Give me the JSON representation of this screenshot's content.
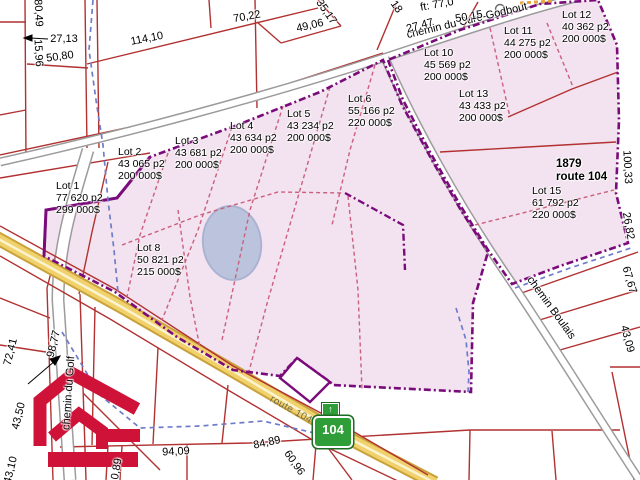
{
  "map": {
    "type": "cadastral-lots-for-sale"
  },
  "colors": {
    "parcel_line_red": "#b23131",
    "highlight_pink": "#f3e2ef",
    "boundary_purple": "#7a0b7a",
    "lot_divider_crimson": "#c9607e",
    "stream_blue": "#6f7cc9",
    "route_yellow": "#f1d16b",
    "shield_green": "#2f9e38",
    "logo_red": "#cf1238",
    "pond_blue": "#bcc3dc"
  },
  "shield": {
    "number": "104",
    "arrow": "↑"
  },
  "labels": [
    {
      "name": "lot-1-label",
      "cls": "lot",
      "anchor": "tl",
      "x": 56,
      "y": 181,
      "rot": 0,
      "lines": [
        "Lot 1",
        "77 620 p2",
        "299 000$"
      ]
    },
    {
      "name": "lot-2-label",
      "cls": "lot",
      "anchor": "tl",
      "x": 118,
      "y": 147,
      "rot": 0,
      "lines": [
        "Lot 2",
        "43 065 p2",
        "200 000$"
      ]
    },
    {
      "name": "lot-3-label",
      "cls": "lot",
      "anchor": "tl",
      "x": 175,
      "y": 136,
      "rot": 0,
      "lines": [
        "Lot 3",
        "43 681 p2",
        "200 000$"
      ]
    },
    {
      "name": "lot-4-label",
      "cls": "lot",
      "anchor": "tl",
      "x": 230,
      "y": 121,
      "rot": 0,
      "lines": [
        "Lot 4",
        "43 634 p2",
        "200 000$"
      ]
    },
    {
      "name": "lot-5-label",
      "cls": "lot",
      "anchor": "tl",
      "x": 287,
      "y": 109,
      "rot": 0,
      "lines": [
        "Lot 5",
        "43 234 p2",
        "200 000$"
      ]
    },
    {
      "name": "lot-6-label",
      "cls": "lot",
      "anchor": "tl",
      "x": 348,
      "y": 94,
      "rot": 0,
      "lines": [
        "Lot 6",
        "55 166 p2",
        "220 000$"
      ]
    },
    {
      "name": "lot-8-label",
      "cls": "lot",
      "anchor": "tl",
      "x": 137,
      "y": 243,
      "rot": 0,
      "lines": [
        "Lot 8",
        "50 821 p2",
        "215 000$"
      ]
    },
    {
      "name": "lot-10-label",
      "cls": "lot",
      "anchor": "tl",
      "x": 424,
      "y": 48,
      "rot": 0,
      "lines": [
        "Lot 10",
        "45 569 p2",
        "200 000$"
      ]
    },
    {
      "name": "lot-11-label",
      "cls": "lot",
      "anchor": "tl",
      "x": 504,
      "y": 26,
      "rot": 0,
      "lines": [
        "Lot 11",
        "44 275 p2",
        "200 000$"
      ]
    },
    {
      "name": "lot-12-label",
      "cls": "lot",
      "anchor": "tl",
      "x": 562,
      "y": 10,
      "rot": 0,
      "lines": [
        "Lot 12",
        "40 362 p2",
        "200 000$"
      ]
    },
    {
      "name": "lot-13-label",
      "cls": "lot",
      "anchor": "tl",
      "x": 459,
      "y": 89,
      "rot": 0,
      "lines": [
        "Lot 13",
        "43 433 p2",
        "200 000$"
      ]
    },
    {
      "name": "lot-15-label",
      "cls": "lot",
      "anchor": "tl",
      "x": 532,
      "y": 186,
      "rot": 0,
      "lines": [
        "Lot 15",
        "61 792 p2",
        "220 000$"
      ]
    },
    {
      "name": "address-1879-route-104",
      "cls": "address",
      "x": 584,
      "y": 171,
      "rot": 0,
      "text": "1879 route 104"
    },
    {
      "name": "street-cure-godbout",
      "cls": "street",
      "x": 467,
      "y": 21,
      "rot": -13.5,
      "text": "chemin du Curé-Godbout"
    },
    {
      "name": "street-boulais",
      "cls": "street",
      "x": 551,
      "y": 308,
      "rot": 54,
      "text": "chemin Boulais"
    },
    {
      "name": "street-golf",
      "cls": "street",
      "x": 69,
      "y": 393,
      "rot": -86,
      "text": "chemin du Golf"
    },
    {
      "name": "street-route-104",
      "cls": "road-name",
      "x": 291,
      "y": 410,
      "rot": 29,
      "text": "route 104"
    },
    {
      "name": "measure-80-49",
      "x": 38,
      "y": 13,
      "rot": 87,
      "text": "80,49"
    },
    {
      "name": "measure-27-13",
      "x": 64,
      "y": 39,
      "rot": 0,
      "text": "27,13"
    },
    {
      "name": "measure-15-96",
      "x": 38,
      "y": 53,
      "rot": 87,
      "text": "15,96"
    },
    {
      "name": "measure-50-80",
      "x": 60,
      "y": 57,
      "rot": -8,
      "text": "50,80"
    },
    {
      "name": "measure-114-10",
      "x": 147,
      "y": 39,
      "rot": -11,
      "text": "114,10"
    },
    {
      "name": "measure-70-22",
      "x": 247,
      "y": 17,
      "rot": -10,
      "text": "70,22"
    },
    {
      "name": "measure-49-06",
      "x": 310,
      "y": 26,
      "rot": -13,
      "text": "49,06"
    },
    {
      "name": "measure-35-17",
      "x": 326,
      "y": 12,
      "rot": 55,
      "text": "35,17"
    },
    {
      "name": "measure-18",
      "x": 396,
      "y": 7,
      "rot": 55,
      "text": "18"
    },
    {
      "name": "measure-ft-77-0",
      "x": 437,
      "y": 5,
      "rot": -10,
      "text": "ft: 77,0"
    },
    {
      "name": "measure-27-47",
      "x": 420,
      "y": 26,
      "rot": -15,
      "text": "27,47"
    },
    {
      "name": "measure-50-15",
      "x": 469,
      "y": 17,
      "rot": -10,
      "text": "50,15"
    },
    {
      "name": "measure-100-33",
      "x": 627,
      "y": 167,
      "rot": 87,
      "text": "100,33"
    },
    {
      "name": "measure-26-82",
      "x": 628,
      "y": 226,
      "rot": 80,
      "text": "26,82"
    },
    {
      "name": "measure-67-67",
      "x": 629,
      "y": 280,
      "rot": 74,
      "text": "67,67"
    },
    {
      "name": "measure-43-09",
      "x": 627,
      "y": 339,
      "rot": 75,
      "text": "43,09"
    },
    {
      "name": "measure-72-41",
      "x": 11,
      "y": 352,
      "rot": -76,
      "text": "72,41"
    },
    {
      "name": "measure-98-77",
      "x": 54,
      "y": 344,
      "rot": -76,
      "text": "98,77"
    },
    {
      "name": "measure-43-50",
      "x": 19,
      "y": 416,
      "rot": -76,
      "text": "43,50"
    },
    {
      "name": "measure-43-10",
      "x": 11,
      "y": 470,
      "rot": -76,
      "text": "43,10"
    },
    {
      "name": "measure-0-89",
      "x": 117,
      "y": 469,
      "rot": -80,
      "text": "0,89"
    },
    {
      "name": "measure-94-09",
      "x": 176,
      "y": 452,
      "rot": -3,
      "text": "94,09"
    },
    {
      "name": "measure-84-89",
      "x": 267,
      "y": 443,
      "rot": -12,
      "text": "84,89"
    },
    {
      "name": "measure-60-96",
      "x": 294,
      "y": 463,
      "rot": 55,
      "text": "60,96"
    }
  ]
}
